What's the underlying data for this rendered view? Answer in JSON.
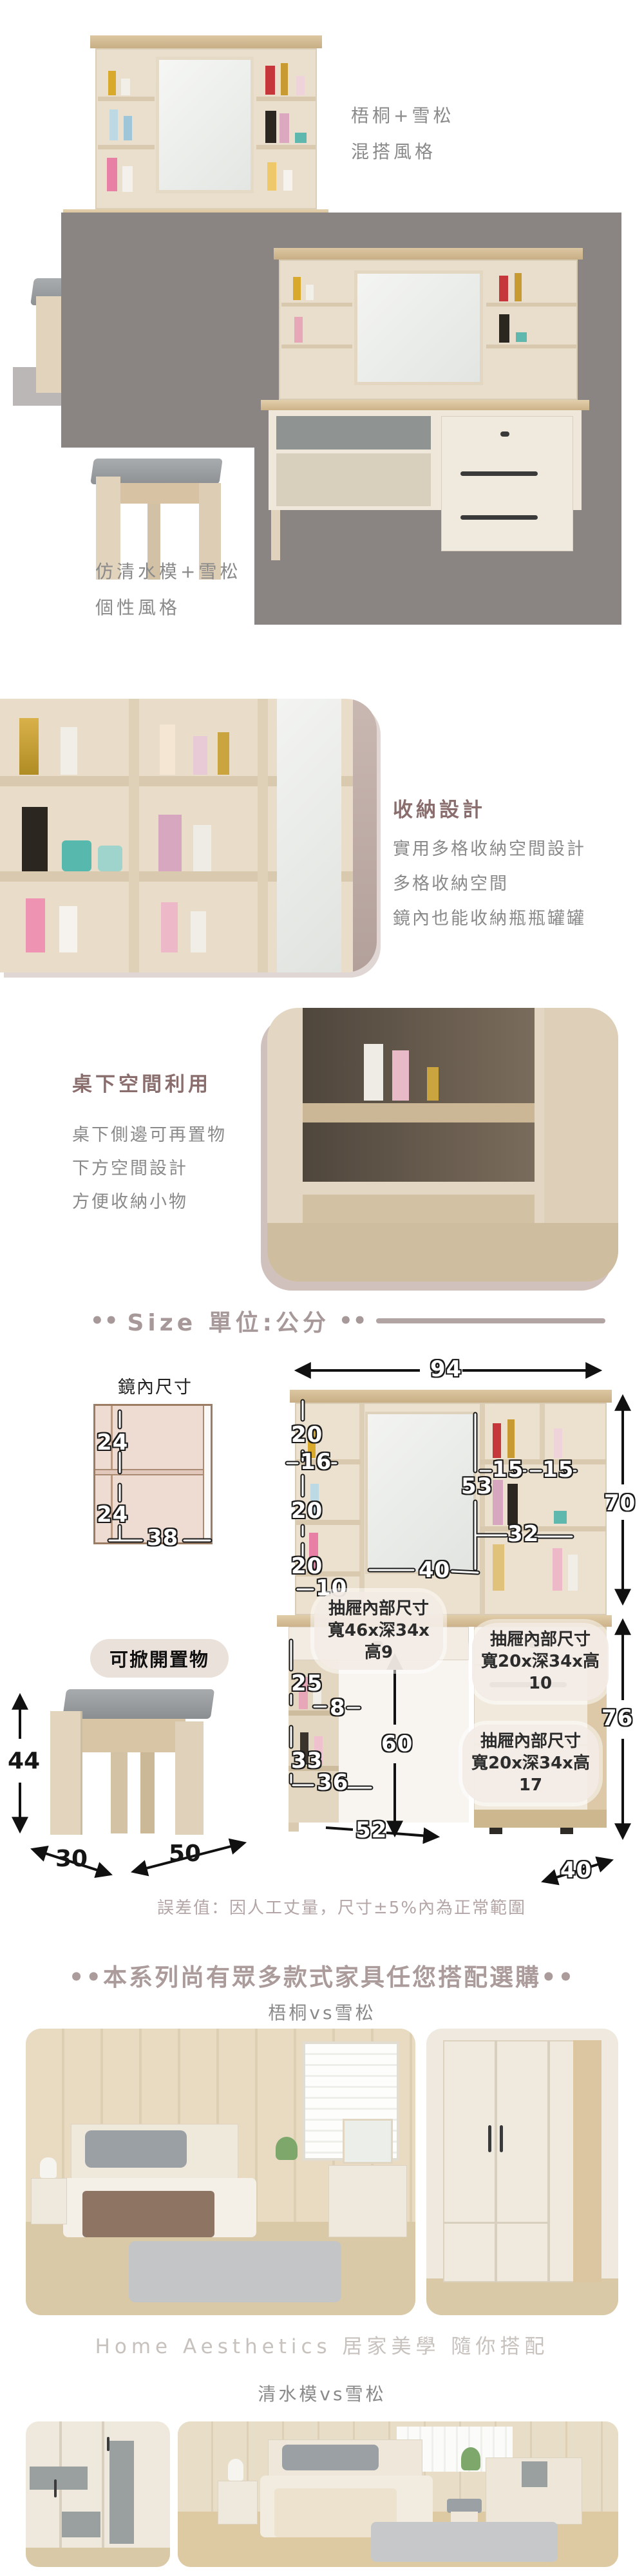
{
  "colors": {
    "accent_mauve": "#ab9b9b",
    "heading_brown": "#8a6e6e",
    "text_gray": "#8a8a8a",
    "photo_bg_gray": "#8a8583",
    "brand_light_gray": "#c8c2be"
  },
  "hero": {
    "style1": {
      "line1": "梧桐+雪松",
      "line2": "混搭風格"
    },
    "style2": {
      "line1": "仿清水模+雪松",
      "line2": "個性風格"
    }
  },
  "storage": {
    "title": "收納設計",
    "line1": "實用多格收納空間設計",
    "line2": "多格收納空間",
    "line3": "鏡內也能收納瓶瓶罐罐"
  },
  "under_desk": {
    "title": "桌下空間利用",
    "line1": "桌下側邊可再置物",
    "line2": "下方空間設計",
    "line3": "方便收納小物"
  },
  "size": {
    "dots": "••",
    "title": "Size 單位:公分",
    "mirror": {
      "label": "鏡內尺寸",
      "h_top": "24",
      "h_bottom": "24",
      "width": "38"
    },
    "stool": {
      "flip_label": "可掀開置物",
      "height": "44",
      "width": "30",
      "depth": "50"
    },
    "main": {
      "total_width": "94",
      "hutch_height": "70",
      "desk_height": "76",
      "shelf_h_top": "20",
      "shelf_w_left": "16",
      "shelf_h_mid": "20",
      "shelf_h_bottom": "20",
      "shelf_w_bottom": "10",
      "mirror_height": "53",
      "mirror_width": "40",
      "right_w1": "15",
      "right_w2": "15",
      "right_w3": "32",
      "side_h1": "25",
      "side_w1": "8",
      "side_h2": "33",
      "side_w2": "36",
      "clearance_h": "60",
      "clearance_w": "52",
      "depth": "40"
    },
    "callout1": {
      "line1": "抽屜內部尺寸",
      "line2": "寬46x深34x高9"
    },
    "callout2": {
      "line1": "抽屜內部尺寸",
      "line2": "寬20x深34x高10"
    },
    "callout3": {
      "line1": "抽屜內部尺寸",
      "line2": "寬20x深34x高17"
    },
    "note": "誤差值：因人工丈量，尺寸±5%內為正常範圍"
  },
  "series": {
    "header": "••本系列尚有眾多款式家具任您搭配選購••",
    "group1": "梧桐vs雪松",
    "brand": "Home Aesthetics 居家美學 隨你搭配",
    "group2": "清水模vs雪松"
  }
}
